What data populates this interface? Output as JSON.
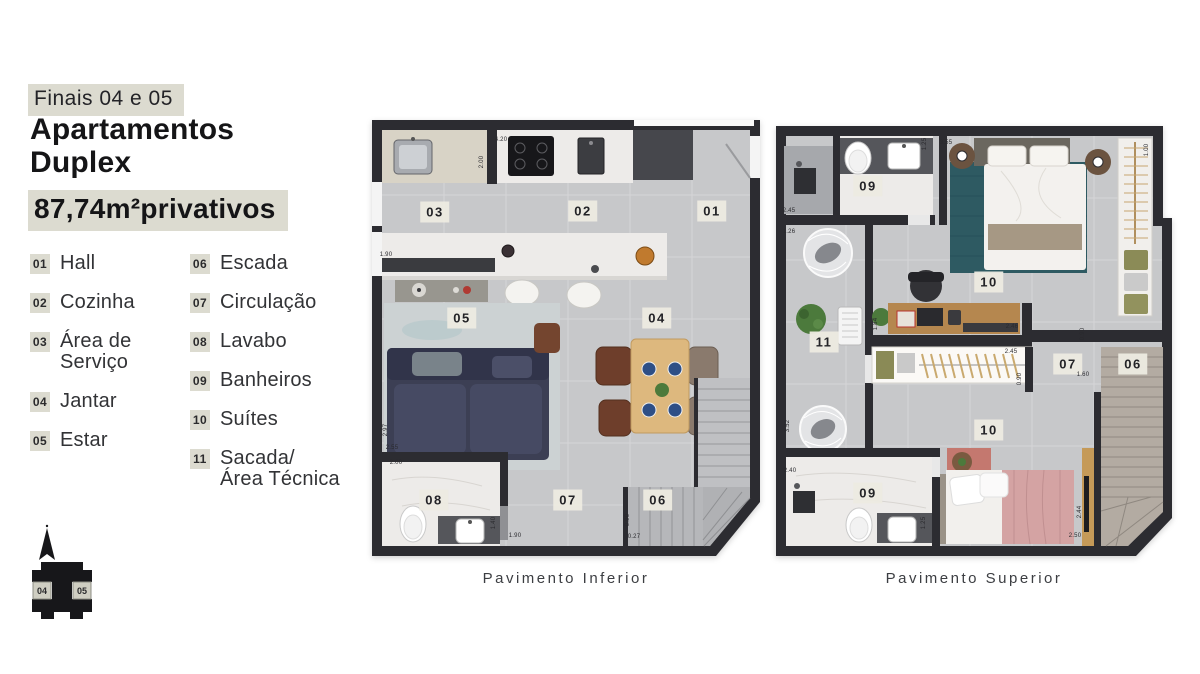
{
  "header": {
    "tag": "Finais 04 e 05",
    "title": "Apartamentos Duplex",
    "area": "87,74m²privativos"
  },
  "legend": {
    "columns": [
      {
        "items": [
          {
            "num": "01",
            "label": "Hall"
          },
          {
            "num": "02",
            "label": "Cozinha"
          },
          {
            "num": "03",
            "label": "Área de\nServiço"
          },
          {
            "num": "04",
            "label": "Jantar"
          },
          {
            "num": "05",
            "label": "Estar"
          }
        ]
      },
      {
        "items": [
          {
            "num": "06",
            "label": "Escada"
          },
          {
            "num": "07",
            "label": "Circulação"
          },
          {
            "num": "08",
            "label": "Lavabo"
          },
          {
            "num": "09",
            "label": "Banheiros"
          },
          {
            "num": "10",
            "label": "Suítes"
          },
          {
            "num": "11",
            "label": "Sacada/\nÁrea Técnica"
          }
        ]
      }
    ]
  },
  "site_icon": {
    "unit_left": "04",
    "unit_right": "05"
  },
  "plans": {
    "inferior": {
      "caption": "Pavimento Inferior",
      "room_labels": [
        {
          "text": "03",
          "x": 63,
          "y": 92
        },
        {
          "text": "02",
          "x": 211,
          "y": 91
        },
        {
          "text": "01",
          "x": 340,
          "y": 91
        },
        {
          "text": "05",
          "x": 90,
          "y": 198
        },
        {
          "text": "04",
          "x": 285,
          "y": 198
        },
        {
          "text": "08",
          "x": 62,
          "y": 380
        },
        {
          "text": "07",
          "x": 196,
          "y": 380
        },
        {
          "text": "06",
          "x": 286,
          "y": 380
        }
      ],
      "dimensions": [
        {
          "text": "4.20",
          "x": 129,
          "y": 20,
          "rot": 0
        },
        {
          "text": "2.00",
          "x": 110,
          "y": 42,
          "rot": 90
        },
        {
          "text": "1.90",
          "x": 14,
          "y": 135,
          "rot": 0
        },
        {
          "text": "2.97",
          "x": 14,
          "y": 310,
          "rot": 90
        },
        {
          "text": "2.55",
          "x": 20,
          "y": 328,
          "rot": 0
        },
        {
          "text": "2.00",
          "x": 24,
          "y": 343,
          "rot": 0
        },
        {
          "text": "1.40",
          "x": 122,
          "y": 403,
          "rot": 90
        },
        {
          "text": "1.90",
          "x": 143,
          "y": 416,
          "rot": 0
        },
        {
          "text": "0.90",
          "x": 256,
          "y": 400,
          "rot": 90
        },
        {
          "text": "0.27",
          "x": 262,
          "y": 417,
          "rot": 0
        }
      ]
    },
    "superior": {
      "caption": "Pavimento Superior",
      "room_labels": [
        {
          "text": "09",
          "x": 92,
          "y": 60
        },
        {
          "text": "10",
          "x": 213,
          "y": 156
        },
        {
          "text": "11",
          "x": 48,
          "y": 216
        },
        {
          "text": "07",
          "x": 292,
          "y": 238
        },
        {
          "text": "06",
          "x": 357,
          "y": 238
        },
        {
          "text": "10",
          "x": 213,
          "y": 304
        },
        {
          "text": "09",
          "x": 92,
          "y": 367
        }
      ],
      "dimensions": [
        {
          "text": "3.55",
          "x": 170,
          "y": 17,
          "rot": 0
        },
        {
          "text": "1.25",
          "x": 149,
          "y": 18,
          "rot": 90
        },
        {
          "text": "1.00",
          "x": 371,
          "y": 24,
          "rot": 90
        },
        {
          "text": "2.45",
          "x": 13,
          "y": 85,
          "rot": 0
        },
        {
          "text": "1.26",
          "x": 13,
          "y": 106,
          "rot": 0
        },
        {
          "text": "1.84",
          "x": 100,
          "y": 198,
          "rot": 90
        },
        {
          "text": "2.46",
          "x": 236,
          "y": 201,
          "rot": 0
        },
        {
          "text": "2.45",
          "x": 235,
          "y": 226,
          "rot": 0
        },
        {
          "text": "0.90",
          "x": 244,
          "y": 253,
          "rot": 90
        },
        {
          "text": "0.90",
          "x": 307,
          "y": 208,
          "rot": 90
        },
        {
          "text": "1.60",
          "x": 307,
          "y": 249,
          "rot": 0
        },
        {
          "text": "3.52",
          "x": 12,
          "y": 300,
          "rot": 90
        },
        {
          "text": "2.40",
          "x": 14,
          "y": 345,
          "rot": 0
        },
        {
          "text": "1.25",
          "x": 148,
          "y": 397,
          "rot": 90
        },
        {
          "text": "2.44",
          "x": 304,
          "y": 386,
          "rot": 90
        },
        {
          "text": "2.50",
          "x": 299,
          "y": 410,
          "rot": 0
        }
      ]
    }
  },
  "colors": {
    "highlight_beige": "#dcdbd0",
    "wall_dark": "#2c2c31",
    "floor_gray": "#c7c8ca",
    "marble_white": "#edebe9",
    "wood": "#ddb87e",
    "sofa_navy": "#3c3f54",
    "rug_teal": "#2e5a62",
    "bed_pink": "#d4a3a3",
    "room_label_bg": "#eceade",
    "text_dark": "#1b1b1d"
  }
}
